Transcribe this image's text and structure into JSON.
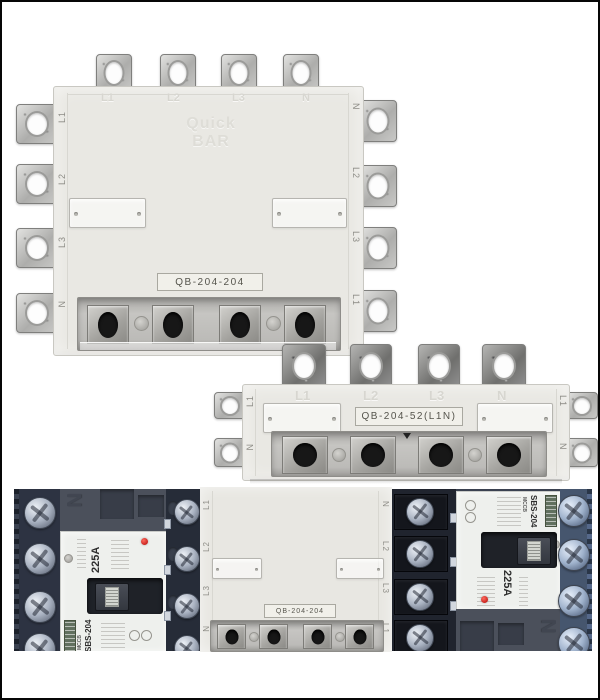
{
  "colors": {
    "background": "#ffffff",
    "frame_border": "#060606",
    "busbar_beige": "#e9e8e3",
    "breaker_body_dark": "#3a4150",
    "indicator_red": "#c8241f",
    "label_plate": "#f1f0ea"
  },
  "top_unit": {
    "model_label": "QB-204-204",
    "watermark": {
      "line1": "Quick",
      "line2": "BAR"
    },
    "embossed_terminals": [
      "L1",
      "L2",
      "L3",
      "N"
    ],
    "left_edge_labels": [
      "L1",
      "L2",
      "L3",
      "N"
    ],
    "right_edge_labels": [
      "N",
      "L2",
      "L3",
      "L1"
    ]
  },
  "middle_unit": {
    "model_label": "QB-204-52(L1N)",
    "embossed_terminals": [
      "L1",
      "L2",
      "L3",
      "N"
    ],
    "left_edge_labels": [
      "L1",
      "N"
    ],
    "right_edge_labels": [
      "L1",
      "N"
    ]
  },
  "bottom_center_unit": {
    "model_label": "QB-204-204",
    "left_edge_labels": [
      "L1",
      "L2",
      "L3",
      "N"
    ],
    "right_edge_labels": [
      "N",
      "L2",
      "L3",
      "L1"
    ]
  },
  "breaker_left": {
    "rating": "225A",
    "type_label": "MCCB",
    "model": "SBS-204",
    "molded_mark": "N"
  },
  "breaker_right": {
    "rating": "225A",
    "type_label": "MCCB",
    "model": "SBS-204",
    "molded_mark": "N"
  }
}
